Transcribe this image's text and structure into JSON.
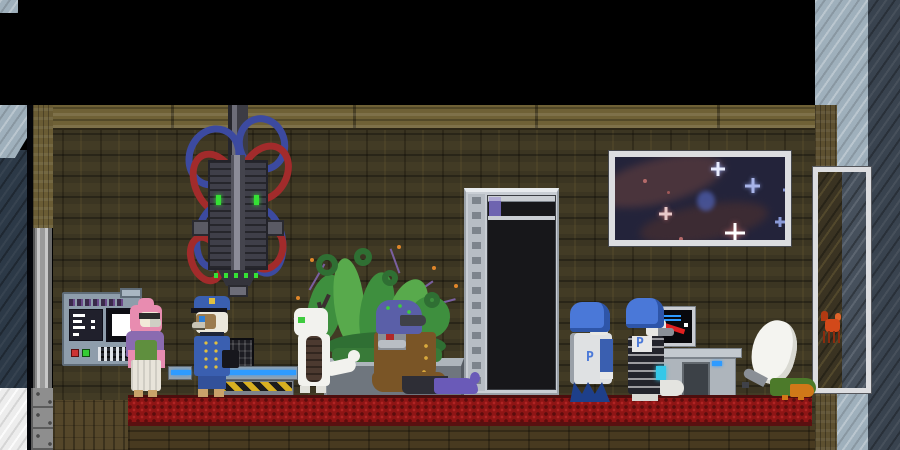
{
  "staff": {
    "apron_letter": "P"
  },
  "shelf": {
    "rows": [
      "tan,red,purple,tan,red",
      "red,red,tan,purple,purple",
      "tan,purple,red,tan,purple",
      "red,tan,purple,red,tan",
      "tan,red,tan,purple,red",
      "red,purple,tan,purple,red",
      "tan,red,purple,tan,red",
      "red,purple,tan,red,purple"
    ]
  },
  "palette": {
    "wall": "#3b3522",
    "band": "#6f6136",
    "carpet": "#8e1515",
    "metal-light": "#9fb0bc",
    "metal-dark": "#39434f",
    "frame": "#dcdde0",
    "space": "#23233a",
    "shelf": "#c9ced4",
    "can-red": "#a63a4a",
    "can-purple": "#6e64b0",
    "can-tan": "#b3895c",
    "planter": "#6f767e",
    "plant": "#3e8f3e",
    "plant-dark": "#2f6f33",
    "console": "#8e9dab",
    "red-btn": "#cc3333",
    "green-btn": "#33cc33",
    "green-light": "#35e035",
    "cable-red": "#a22b2b",
    "cable-blue": "#3c4aa0",
    "neon": "#2e9bff",
    "hazard": "#d8b021",
    "mon-blue": "#2e9bff",
    "mon-red": "#e02020",
    "pink": "#e88cb0",
    "purple": "#8a6bb0",
    "green-dress": "#5f8f3e",
    "police": "#3a5fb0",
    "dragon-eye": "#3ecb3e",
    "merchant-head": "#5a5fa8",
    "coat": "#7a5526",
    "boot": "#6a5ab8",
    "staff-hair": "#4a78d8",
    "staff-fin": "#1e3f8a",
    "fowl-green": "#4c7a2a",
    "fowl-orange": "#d07818",
    "crab": "#d2491a"
  },
  "entities": [
    "ceiling-void",
    "wood-wall",
    "red-carpet",
    "wall-console",
    "ceiling-machine",
    "pink-avian-npc",
    "police-avian-npc",
    "cash-counter",
    "white-dragon-npc",
    "curly-plant",
    "coated-merchant-npc",
    "supply-shelf",
    "space-poster",
    "staff-npc-1",
    "staff-npc-2",
    "chart-monitor",
    "office-desk",
    "white-fowl",
    "side-window",
    "window-crab",
    "metal-pillar"
  ]
}
